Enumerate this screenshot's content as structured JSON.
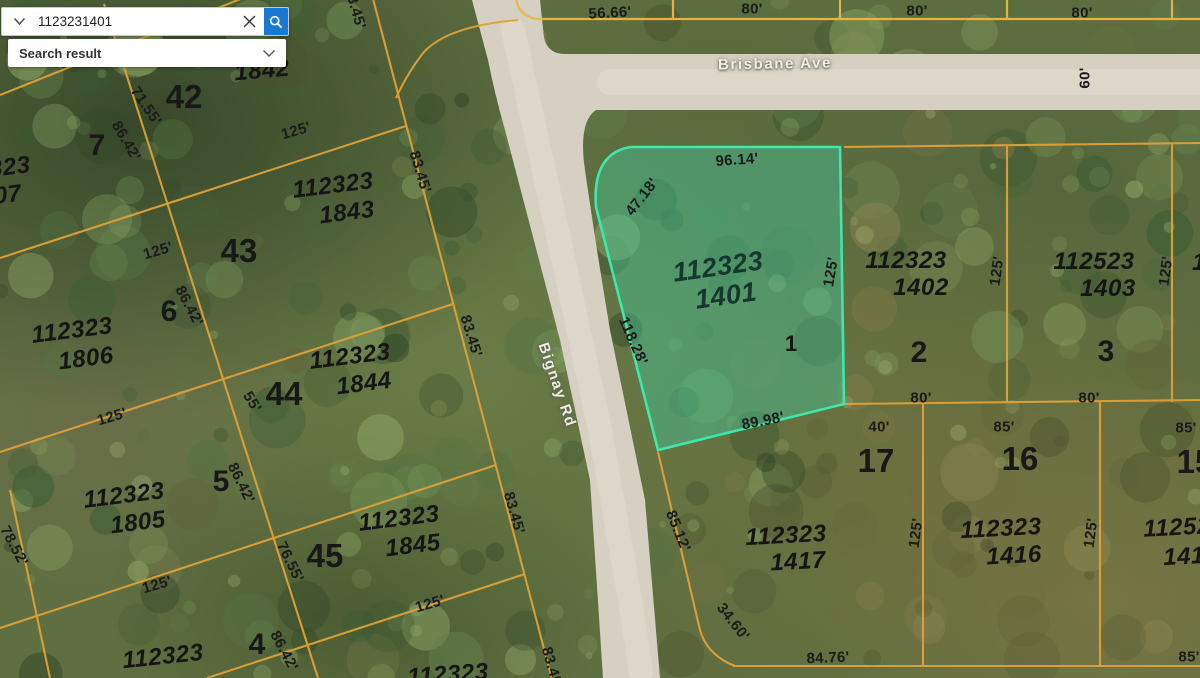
{
  "search": {
    "query": "1123231401",
    "result_label": "Search result",
    "accent_blue": "#1779d1"
  },
  "map": {
    "selected_parcel_id": "112323 1401",
    "streets": [
      "Brisbane Ave",
      "Bignay Rd"
    ],
    "colors": {
      "parcel_line": "#e0a136",
      "north_line": "#eeb544",
      "highlight_stroke": "#3fe7ab",
      "highlight_fill": "rgba(62,214,170,0.38)",
      "road": "#d6d0c3"
    },
    "labels": [
      {
        "t": "Brisbane Ave",
        "x": 775,
        "y": 64,
        "r": -1,
        "k": "st"
      },
      {
        "t": "Bignay Rd",
        "x": 557,
        "y": 385,
        "r": 71,
        "k": "st"
      },
      {
        "t": "56.66'",
        "x": 610,
        "y": 13,
        "r": -3,
        "k": "d"
      },
      {
        "t": "80'",
        "x": 752,
        "y": 9,
        "r": 0,
        "k": "d"
      },
      {
        "t": "80'",
        "x": 917,
        "y": 11,
        "r": 0,
        "k": "d"
      },
      {
        "t": "80'",
        "x": 1082,
        "y": 13,
        "r": 0,
        "k": "d"
      },
      {
        "t": "60'",
        "x": 1085,
        "y": 78,
        "r": -90,
        "k": "d"
      },
      {
        "t": "83.45'",
        "x": 355,
        "y": 8,
        "r": 74,
        "k": "d"
      },
      {
        "t": "96.14'",
        "x": 737,
        "y": 160,
        "r": -4,
        "k": "d"
      },
      {
        "t": "47.18'",
        "x": 642,
        "y": 197,
        "r": -52,
        "k": "d"
      },
      {
        "t": "112323",
        "x": 718,
        "y": 267,
        "r": -8,
        "k": "pl"
      },
      {
        "t": "1401",
        "x": 726,
        "y": 296,
        "r": -8,
        "k": "pl"
      },
      {
        "t": "125'",
        "x": 831,
        "y": 272,
        "r": -80,
        "k": "d"
      },
      {
        "t": "118.28'",
        "x": 633,
        "y": 341,
        "r": 66,
        "k": "d"
      },
      {
        "t": "1",
        "x": 791,
        "y": 344,
        "r": 0,
        "k": "l",
        "s": 22
      },
      {
        "t": "89.98'",
        "x": 763,
        "y": 421,
        "r": -11,
        "k": "d"
      },
      {
        "t": "112323",
        "x": 906,
        "y": 261,
        "r": 0,
        "k": "p"
      },
      {
        "t": "1402",
        "x": 921,
        "y": 288,
        "r": 0,
        "k": "p"
      },
      {
        "t": "2",
        "x": 919,
        "y": 353,
        "r": 0,
        "k": "l"
      },
      {
        "t": "125'",
        "x": 997,
        "y": 271,
        "r": -82,
        "k": "d"
      },
      {
        "t": "112523",
        "x": 1094,
        "y": 262,
        "r": 0,
        "k": "p"
      },
      {
        "t": "1403",
        "x": 1108,
        "y": 289,
        "r": 0,
        "k": "p"
      },
      {
        "t": "3",
        "x": 1106,
        "y": 352,
        "r": 0,
        "k": "l"
      },
      {
        "t": "125'",
        "x": 1166,
        "y": 271,
        "r": -82,
        "k": "d"
      },
      {
        "t": "80'",
        "x": 921,
        "y": 398,
        "r": 0,
        "k": "d"
      },
      {
        "t": "80'",
        "x": 1089,
        "y": 398,
        "r": 0,
        "k": "d"
      },
      {
        "t": "1",
        "x": 1199,
        "y": 263,
        "r": 0,
        "k": "p"
      },
      {
        "t": "40'",
        "x": 879,
        "y": 427,
        "r": 0,
        "k": "d"
      },
      {
        "t": "17",
        "x": 876,
        "y": 461,
        "r": 0,
        "k": "l",
        "s": 33
      },
      {
        "t": "85'",
        "x": 1004,
        "y": 427,
        "r": 0,
        "k": "d"
      },
      {
        "t": "16",
        "x": 1020,
        "y": 459,
        "r": 0,
        "k": "l",
        "s": 33
      },
      {
        "t": "85'",
        "x": 1186,
        "y": 428,
        "r": 0,
        "k": "d"
      },
      {
        "t": "15",
        "x": 1195,
        "y": 462,
        "r": 0,
        "k": "l",
        "s": 33
      },
      {
        "t": "125'",
        "x": 916,
        "y": 533,
        "r": -82,
        "k": "d"
      },
      {
        "t": "112323",
        "x": 1001,
        "y": 529,
        "r": -3,
        "k": "p"
      },
      {
        "t": "1416",
        "x": 1014,
        "y": 556,
        "r": -3,
        "k": "p"
      },
      {
        "t": "125'",
        "x": 1091,
        "y": 533,
        "r": -82,
        "k": "d"
      },
      {
        "t": "11252",
        "x": 1177,
        "y": 528,
        "r": -3,
        "k": "p"
      },
      {
        "t": "141",
        "x": 1184,
        "y": 557,
        "r": -3,
        "k": "p"
      },
      {
        "t": "85'",
        "x": 1189,
        "y": 657,
        "r": 0,
        "k": "d"
      },
      {
        "t": "112323",
        "x": 786,
        "y": 536,
        "r": -3,
        "k": "p"
      },
      {
        "t": "1417",
        "x": 798,
        "y": 562,
        "r": -3,
        "k": "p"
      },
      {
        "t": "85.12'",
        "x": 678,
        "y": 531,
        "r": 68,
        "k": "d"
      },
      {
        "t": "34.60'",
        "x": 733,
        "y": 622,
        "r": 52,
        "k": "d"
      },
      {
        "t": "84.76'",
        "x": 828,
        "y": 658,
        "r": -2,
        "k": "d"
      },
      {
        "t": "112323",
        "x": 448,
        "y": 675,
        "r": -4,
        "k": "p"
      },
      {
        "t": "83.45'",
        "x": 552,
        "y": 668,
        "r": 74,
        "k": "d"
      },
      {
        "t": "1842",
        "x": 262,
        "y": 71,
        "r": -5,
        "k": "p"
      },
      {
        "t": "42",
        "x": 184,
        "y": 97,
        "r": 0,
        "k": "l",
        "s": 33
      },
      {
        "t": "7",
        "x": 97,
        "y": 146,
        "r": 0,
        "k": "l"
      },
      {
        "t": "71.55'",
        "x": 146,
        "y": 106,
        "r": 56,
        "k": "d"
      },
      {
        "t": "86.42'",
        "x": 126,
        "y": 141,
        "r": 60,
        "k": "d"
      },
      {
        "t": "112323",
        "x": 333,
        "y": 186,
        "r": -7,
        "k": "p"
      },
      {
        "t": "1843",
        "x": 347,
        "y": 213,
        "r": -7,
        "k": "p"
      },
      {
        "t": "83.45'",
        "x": 420,
        "y": 172,
        "r": 73,
        "k": "d"
      },
      {
        "t": "125'",
        "x": 296,
        "y": 131,
        "r": -16,
        "k": "d"
      },
      {
        "t": "125'",
        "x": 158,
        "y": 251,
        "r": -16,
        "k": "d"
      },
      {
        "t": "43",
        "x": 239,
        "y": 251,
        "r": 0,
        "k": "l",
        "s": 33
      },
      {
        "t": "6",
        "x": 169,
        "y": 312,
        "r": 0,
        "k": "l"
      },
      {
        "t": "86.42'",
        "x": 189,
        "y": 306,
        "r": 62,
        "k": "d"
      },
      {
        "t": "112323",
        "x": 72,
        "y": 331,
        "r": -7,
        "k": "p"
      },
      {
        "t": "1806",
        "x": 86,
        "y": 359,
        "r": -7,
        "k": "p"
      },
      {
        "t": "112323",
        "x": 350,
        "y": 357,
        "r": -7,
        "k": "p"
      },
      {
        "t": "1844",
        "x": 364,
        "y": 384,
        "r": -7,
        "k": "p"
      },
      {
        "t": "44",
        "x": 284,
        "y": 394,
        "r": 0,
        "k": "l",
        "s": 33
      },
      {
        "t": "83.45'",
        "x": 471,
        "y": 336,
        "r": 73,
        "k": "d"
      },
      {
        "t": "125'",
        "x": 112,
        "y": 417,
        "r": -16,
        "k": "d"
      },
      {
        "t": "55'",
        "x": 252,
        "y": 402,
        "r": 58,
        "k": "d"
      },
      {
        "t": "112323",
        "x": 124,
        "y": 496,
        "r": -7,
        "k": "p"
      },
      {
        "t": "1805",
        "x": 138,
        "y": 523,
        "r": -7,
        "k": "p"
      },
      {
        "t": "5",
        "x": 221,
        "y": 482,
        "r": 0,
        "k": "l"
      },
      {
        "t": "86.42'",
        "x": 241,
        "y": 483,
        "r": 64,
        "k": "d"
      },
      {
        "t": "78.52'",
        "x": 14,
        "y": 546,
        "r": 62,
        "k": "d"
      },
      {
        "t": "45",
        "x": 325,
        "y": 556,
        "r": 0,
        "k": "l",
        "s": 33
      },
      {
        "t": "112323",
        "x": 399,
        "y": 519,
        "r": -7,
        "k": "p"
      },
      {
        "t": "1845",
        "x": 413,
        "y": 546,
        "r": -7,
        "k": "p"
      },
      {
        "t": "83.45'",
        "x": 514,
        "y": 513,
        "r": 74,
        "k": "d"
      },
      {
        "t": "76.55'",
        "x": 290,
        "y": 562,
        "r": 64,
        "k": "d"
      },
      {
        "t": "125'",
        "x": 157,
        "y": 585,
        "r": -16,
        "k": "d"
      },
      {
        "t": "125'",
        "x": 430,
        "y": 604,
        "r": -16,
        "k": "d"
      },
      {
        "t": "112323",
        "x": 163,
        "y": 657,
        "r": -6,
        "k": "p"
      },
      {
        "t": "4",
        "x": 257,
        "y": 645,
        "r": 0,
        "k": "l"
      },
      {
        "t": "86.42'",
        "x": 284,
        "y": 651,
        "r": 62,
        "k": "d"
      },
      {
        "t": "112323",
        "x": -10,
        "y": 170,
        "r": -7,
        "k": "p"
      },
      {
        "t": "1807",
        "x": -6,
        "y": 197,
        "r": -7,
        "k": "p"
      }
    ]
  }
}
